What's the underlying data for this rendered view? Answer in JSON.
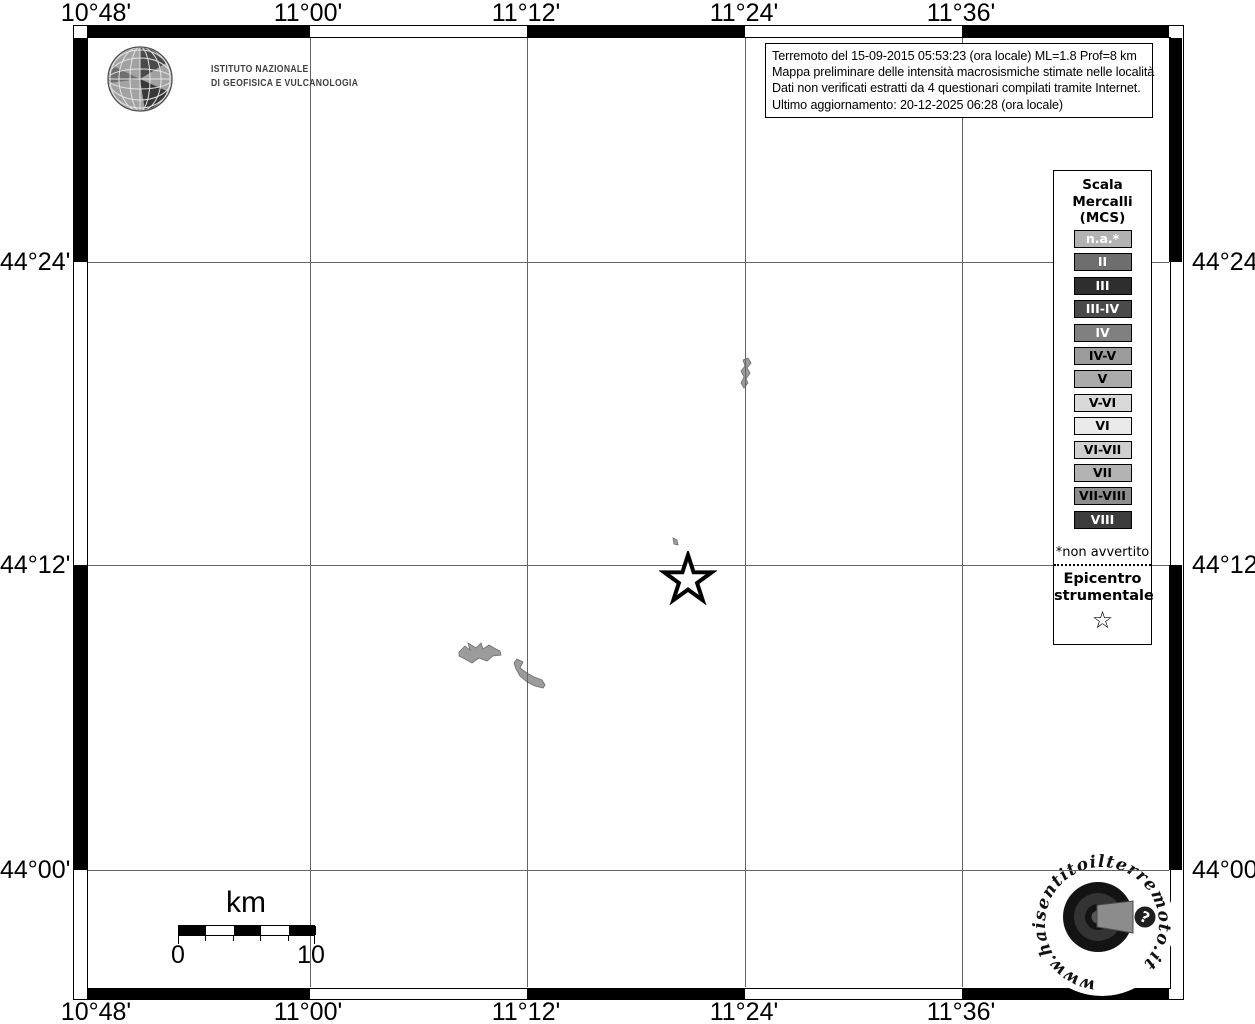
{
  "axes": {
    "lon_labels": [
      "10°48'",
      "11°00'",
      "11°12'",
      "11°24'",
      "11°36'"
    ],
    "lat_labels": [
      "44°24'",
      "44°12'",
      "44°00'"
    ]
  },
  "header": {
    "ingv_line1": "ISTITUTO NAZIONALE",
    "ingv_line2": "DI GEOFISICA E VULCANOLOGIA"
  },
  "info_box": {
    "lines": [
      "Terremoto del 15-09-2015 05:53:23 (ora locale) ML=1.8 Prof=8 km",
      "Mappa preliminare delle intensità macrosismiche stimate nelle località",
      "Dati non verificati estratti da 4 questionari compilati tramite Internet.",
      "Ultimo aggiornamento: 20-12-2025 06:28 (ora locale)"
    ]
  },
  "legend": {
    "title_lines": [
      "Scala",
      "Mercalli",
      "(MCS)"
    ],
    "items": [
      {
        "label": "n.a.*",
        "bg": "#b2b2b2",
        "fg": "#ffffff"
      },
      {
        "label": "II",
        "bg": "#6e6e6e",
        "fg": "#ffffff"
      },
      {
        "label": "III",
        "bg": "#2e2e2e",
        "fg": "#ffffff"
      },
      {
        "label": "III-IV",
        "bg": "#4a4a4a",
        "fg": "#ffffff"
      },
      {
        "label": "IV",
        "bg": "#808080",
        "fg": "#ffffff"
      },
      {
        "label": "IV-V",
        "bg": "#9b9b9b",
        "fg": "#000000"
      },
      {
        "label": "V",
        "bg": "#ababab",
        "fg": "#000000"
      },
      {
        "label": "V-VI",
        "bg": "#d9d9d9",
        "fg": "#000000"
      },
      {
        "label": "VI",
        "bg": "#eaeaea",
        "fg": "#000000"
      },
      {
        "label": "VI-VII",
        "bg": "#cfcfcf",
        "fg": "#000000"
      },
      {
        "label": "VII",
        "bg": "#b3b3b3",
        "fg": "#000000"
      },
      {
        "label": "VII-VIII",
        "bg": "#8d8d8d",
        "fg": "#000000"
      },
      {
        "label": "VIII",
        "bg": "#3c3c3c",
        "fg": "#ffffff"
      }
    ],
    "footnote": "*non avvertito",
    "epicenter_lines": [
      "Epicentro",
      "strumentale"
    ],
    "epicenter_star": "☆"
  },
  "scale_bar": {
    "unit": "km",
    "start": "0",
    "end": "10"
  },
  "logos": {
    "hsit_text": "www.haisentitoilterremoto.it",
    "hsit_question": "?"
  }
}
